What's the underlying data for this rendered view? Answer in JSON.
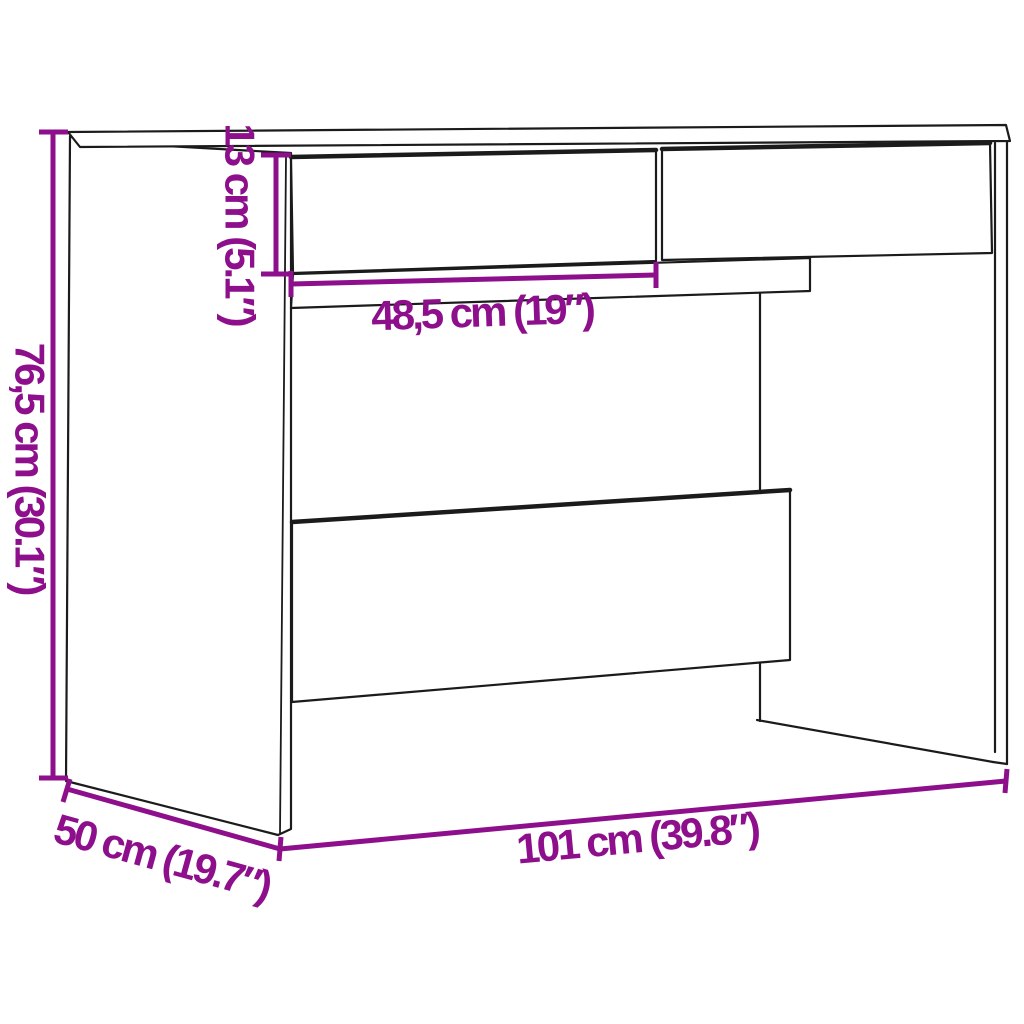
{
  "diagram": {
    "type": "product-dimension-diagram",
    "subject": "desk-with-two-drawers",
    "colors": {
      "background": "#ffffff",
      "outline": "#1b1b1b",
      "dimension": "#8e0f8c"
    },
    "labels": {
      "height": "76,5 cm (30.1″)",
      "drawer_height": "13 cm (5.1″)",
      "drawer_opening_width": "48,5 cm (19″)",
      "width": "101 cm (39.8″)",
      "depth": "50 cm (19.7″)"
    },
    "dimensions": [
      {
        "role": "overall height",
        "metric": "76,5 cm",
        "imperial": "30.1″"
      },
      {
        "role": "drawer front height",
        "metric": "13 cm",
        "imperial": "5.1″"
      },
      {
        "role": "drawer width",
        "metric": "48,5 cm",
        "imperial": "19″"
      },
      {
        "role": "overall width",
        "metric": "101 cm",
        "imperial": "39.8″"
      },
      {
        "role": "overall depth",
        "metric": "50 cm",
        "imperial": "19.7″"
      }
    ]
  }
}
